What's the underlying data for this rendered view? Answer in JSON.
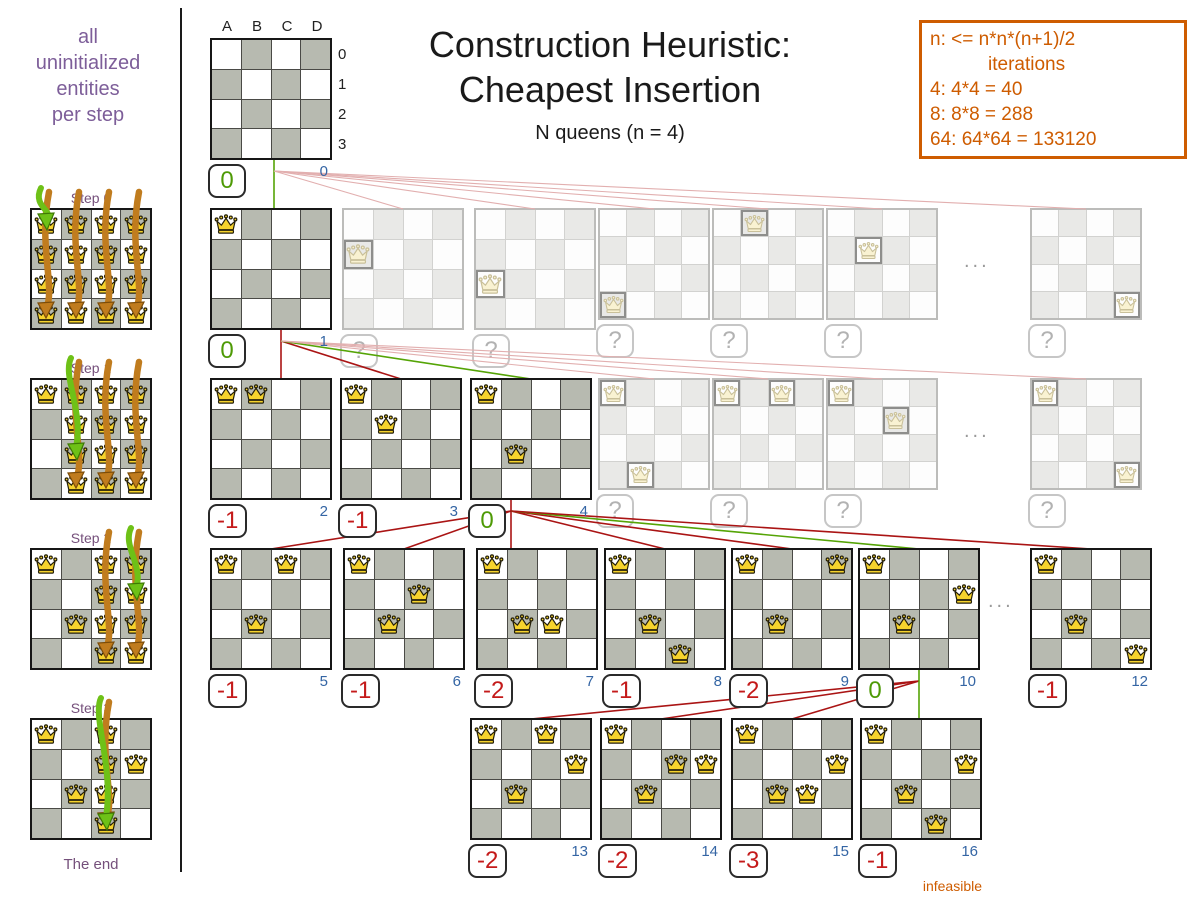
{
  "header": {
    "title_line1": "Construction Heuristic:",
    "title_line2": "Cheapest Insertion",
    "subtitle": "N queens (n = 4)"
  },
  "info_box": {
    "lines": [
      "n: <= n*n*(n+1)/2",
      "iterations",
      "4: 4*4 = 40",
      "8: 8*8 = 288",
      "64: 64*64 = 133120"
    ]
  },
  "sidebar": {
    "intro_lines": [
      "all",
      "uninitialized",
      "entities",
      "per step"
    ],
    "steps": [
      {
        "label": "Step 0",
        "fixed": [],
        "arrow_cols": [
          "A",
          "B",
          "C",
          "D"
        ],
        "green_target": "A0"
      },
      {
        "label": "Step 1",
        "fixed": [
          "A0"
        ],
        "arrow_cols": [
          "B",
          "C",
          "D"
        ],
        "green_target": "B2"
      },
      {
        "label": "Step 2",
        "fixed": [
          "A0",
          "B2"
        ],
        "arrow_cols": [
          "C",
          "D"
        ],
        "green_target": "D1"
      },
      {
        "label": "Step 3",
        "fixed": [
          "A0",
          "B2",
          "D1"
        ],
        "arrow_cols": [
          "C"
        ],
        "green_target": "C3"
      }
    ],
    "end_label": "The end"
  },
  "board_labels": {
    "columns": [
      "A",
      "B",
      "C",
      "D"
    ],
    "rows": [
      "0",
      "1",
      "2",
      "3"
    ]
  },
  "tree": {
    "boards": [
      {
        "id": "root",
        "x": 210,
        "y": 38,
        "state": "active",
        "queens": [],
        "score": "0",
        "score_color": "green",
        "iter": "0",
        "fan_x": 274,
        "axis_labels": true
      },
      {
        "id": "r1b1",
        "x": 210,
        "y": 208,
        "state": "active",
        "queens": [
          "A0"
        ],
        "score": "0",
        "score_color": "green",
        "iter": "1",
        "fan_x": 281
      },
      {
        "id": "r1b2",
        "x": 342,
        "y": 208,
        "state": "faded",
        "queens": [
          "A1"
        ],
        "score": "?"
      },
      {
        "id": "r1b3",
        "x": 474,
        "y": 208,
        "state": "faded",
        "queens": [
          "A2"
        ],
        "score": "?"
      },
      {
        "id": "r1b4",
        "x": 598,
        "y": 208,
        "state": "faded",
        "small": true,
        "queens": [
          "A3"
        ],
        "score": "?"
      },
      {
        "id": "r1b5",
        "x": 712,
        "y": 208,
        "state": "faded",
        "small": true,
        "queens": [
          "B0"
        ],
        "score": "?"
      },
      {
        "id": "r1b6",
        "x": 826,
        "y": 208,
        "state": "faded",
        "small": true,
        "queens": [
          "B1"
        ],
        "score": "?"
      },
      {
        "id": "r1b7",
        "x": 1030,
        "y": 208,
        "state": "faded",
        "small": true,
        "queens": [
          "D3"
        ],
        "score": "?"
      },
      {
        "id": "r2b1",
        "x": 210,
        "y": 378,
        "state": "active",
        "queens": [
          "A0",
          "B0"
        ],
        "score": "-1",
        "score_color": "red",
        "iter": "2"
      },
      {
        "id": "r2b2",
        "x": 340,
        "y": 378,
        "state": "active",
        "queens": [
          "A0",
          "B1"
        ],
        "score": "-1",
        "score_color": "red",
        "iter": "3"
      },
      {
        "id": "r2b3",
        "x": 470,
        "y": 378,
        "state": "active",
        "queens": [
          "A0",
          "B2"
        ],
        "score": "0",
        "score_color": "green",
        "iter": "4",
        "fan_x": 511
      },
      {
        "id": "r2b4",
        "x": 598,
        "y": 378,
        "state": "faded",
        "small": true,
        "queens": [
          "A0",
          "B3"
        ],
        "score": "?"
      },
      {
        "id": "r2b5",
        "x": 712,
        "y": 378,
        "state": "faded",
        "small": true,
        "queens": [
          "A0",
          "C0"
        ],
        "score": "?"
      },
      {
        "id": "r2b6",
        "x": 826,
        "y": 378,
        "state": "faded",
        "small": true,
        "queens": [
          "A0",
          "C1"
        ],
        "score": "?"
      },
      {
        "id": "r2b7",
        "x": 1030,
        "y": 378,
        "state": "faded",
        "small": true,
        "queens": [
          "A0",
          "D3"
        ],
        "score": "?"
      },
      {
        "id": "r3b1",
        "x": 210,
        "y": 548,
        "state": "active",
        "queens": [
          "A0",
          "B2",
          "C0"
        ],
        "score": "-1",
        "score_color": "red",
        "iter": "5"
      },
      {
        "id": "r3b2",
        "x": 343,
        "y": 548,
        "state": "active",
        "queens": [
          "A0",
          "B2",
          "C1"
        ],
        "score": "-1",
        "score_color": "red",
        "iter": "6"
      },
      {
        "id": "r3b3",
        "x": 476,
        "y": 548,
        "state": "active",
        "queens": [
          "A0",
          "B2",
          "C2"
        ],
        "score": "-2",
        "score_color": "red",
        "iter": "7"
      },
      {
        "id": "r3b4",
        "x": 604,
        "y": 548,
        "state": "active",
        "queens": [
          "A0",
          "B2",
          "C3"
        ],
        "score": "-1",
        "score_color": "red",
        "iter": "8"
      },
      {
        "id": "r3b5",
        "x": 731,
        "y": 548,
        "state": "active",
        "queens": [
          "A0",
          "B2",
          "D0"
        ],
        "score": "-2",
        "score_color": "red",
        "iter": "9"
      },
      {
        "id": "r3b6",
        "x": 858,
        "y": 548,
        "state": "active",
        "queens": [
          "A0",
          "B2",
          "D1"
        ],
        "score": "0",
        "score_color": "green",
        "iter": "10",
        "fan_x": 919
      },
      {
        "id": "r3b7",
        "x": 1030,
        "y": 548,
        "state": "active",
        "queens": [
          "A0",
          "B2",
          "D3"
        ],
        "score": "-1",
        "score_color": "red",
        "iter": "12"
      },
      {
        "id": "r4b1",
        "x": 470,
        "y": 718,
        "state": "active",
        "queens": [
          "A0",
          "B2",
          "D1",
          "C0"
        ],
        "score": "-2",
        "score_color": "red",
        "iter": "13"
      },
      {
        "id": "r4b2",
        "x": 600,
        "y": 718,
        "state": "active",
        "queens": [
          "A0",
          "B2",
          "D1",
          "C1"
        ],
        "score": "-2",
        "score_color": "red",
        "iter": "14"
      },
      {
        "id": "r4b3",
        "x": 731,
        "y": 718,
        "state": "active",
        "queens": [
          "A0",
          "B2",
          "D1",
          "C2"
        ],
        "score": "-3",
        "score_color": "red",
        "iter": "15"
      },
      {
        "id": "r4b4",
        "x": 860,
        "y": 718,
        "state": "active",
        "queens": [
          "A0",
          "B2",
          "D1",
          "C3"
        ],
        "score": "-1",
        "score_color": "red",
        "iter": "16",
        "note": "infeasible"
      }
    ],
    "edges": [
      {
        "p": "root",
        "c": "r1b1",
        "k": "green"
      },
      {
        "p": "root",
        "c": "r1b2",
        "k": "pink"
      },
      {
        "p": "root",
        "c": "r1b3",
        "k": "pink"
      },
      {
        "p": "root",
        "c": "r1b4",
        "k": "pink"
      },
      {
        "p": "root",
        "c": "r1b5",
        "k": "pink"
      },
      {
        "p": "root",
        "c": "r1b6",
        "k": "pink"
      },
      {
        "p": "root",
        "c": "r1b7",
        "k": "pink"
      },
      {
        "p": "r1b1",
        "c": "r2b1",
        "k": "red"
      },
      {
        "p": "r1b1",
        "c": "r2b2",
        "k": "red"
      },
      {
        "p": "r1b1",
        "c": "r2b3",
        "k": "green"
      },
      {
        "p": "r1b1",
        "c": "r2b4",
        "k": "pink"
      },
      {
        "p": "r1b1",
        "c": "r2b5",
        "k": "pink"
      },
      {
        "p": "r1b1",
        "c": "r2b6",
        "k": "pink"
      },
      {
        "p": "r1b1",
        "c": "r2b7",
        "k": "pink"
      },
      {
        "p": "r2b3",
        "c": "r3b1",
        "k": "red"
      },
      {
        "p": "r2b3",
        "c": "r3b2",
        "k": "red"
      },
      {
        "p": "r2b3",
        "c": "r3b3",
        "k": "red"
      },
      {
        "p": "r2b3",
        "c": "r3b4",
        "k": "red"
      },
      {
        "p": "r2b3",
        "c": "r3b5",
        "k": "red"
      },
      {
        "p": "r2b3",
        "c": "r3b6",
        "k": "green"
      },
      {
        "p": "r2b3",
        "c": "r3b7",
        "k": "red"
      },
      {
        "p": "r3b6",
        "c": "r4b1",
        "k": "red"
      },
      {
        "p": "r3b6",
        "c": "r4b2",
        "k": "red"
      },
      {
        "p": "r3b6",
        "c": "r4b3",
        "k": "red"
      },
      {
        "p": "r3b6",
        "c": "r4b4",
        "k": "green"
      }
    ],
    "ellipses": [
      {
        "x": 964,
        "y": 250,
        "text": "..."
      },
      {
        "x": 964,
        "y": 420,
        "text": "..."
      },
      {
        "x": 988,
        "y": 590,
        "text": "..."
      }
    ]
  },
  "colors": {
    "purple": "#7d5e99",
    "step_purple": "#75507b",
    "orange": "#ce5c00",
    "blue": "#3465a4",
    "green": "#4e9a06",
    "red": "#c41a1a",
    "gray_cell": "#b7bab0",
    "edge_red": "#aa1414",
    "edge_green": "#55a406",
    "edge_pink": "#e2afaf",
    "arrow_orange": "#c07c1e",
    "arrow_green": "#6ec117"
  }
}
